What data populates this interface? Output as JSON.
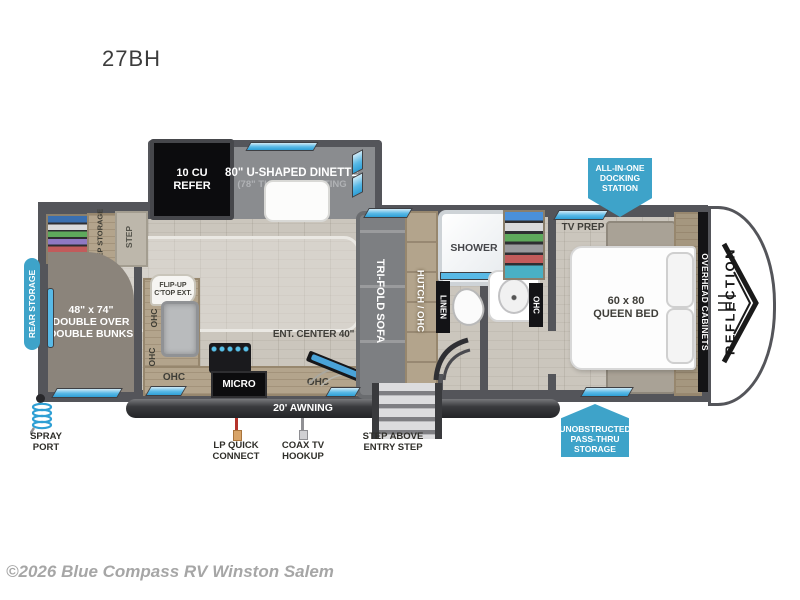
{
  "page": {
    "title": "27BH",
    "watermark": "©2026 Blue Compass RV Winston Salem"
  },
  "colors": {
    "badge_blue": "#3ea3c9",
    "wall_gray": "#54555a",
    "window_blue": "#58b9e6",
    "floor_wood": "#cbc6bd"
  },
  "floorplan": {
    "brand": "REFLECTION",
    "badges": {
      "docking_station": "ALL-IN-ONE\nDOCKING\nSTATION",
      "pass_thru": "UNOBSTRUCTED\nPASS-THRU\nSTORAGE",
      "rear_storage": "REAR STORAGE"
    },
    "bunk_room": {
      "bunks": "48\" x 74\"\nDOUBLE OVER\nDOUBLE BUNKS",
      "step_storage": "STEP STORAGE",
      "step": "STEP"
    },
    "kitchen": {
      "refer": "10 CU\nREFER",
      "flip_up": "FLIP-UP\nC'TOP EXT.",
      "micro": "MICRO",
      "ohc": "OHC"
    },
    "dinette": {
      "line1": "80\" U-SHAPED DINETTE",
      "line2": "(78\" THEATRE SEATING",
      "line3": "OPTIONAL)"
    },
    "living": {
      "sofa": "TRI-FOLD SOFA",
      "hutch": "HUTCH / OHC",
      "ent_center": "ENT. CENTER 40\" TV"
    },
    "bath": {
      "shower": "SHOWER",
      "linen": "LINEN",
      "ohc": "OHC"
    },
    "bedroom": {
      "tv_prep": "TV PREP",
      "bed": "60 x 80\nQUEEN BED",
      "overhead": "OVERHEAD CABINETS"
    },
    "exterior": {
      "awning": "20' AWNING",
      "spray_port": "SPRAY\nPORT",
      "lp_quick": "LP QUICK\nCONNECT",
      "coax": "COAX TV\nHOOKUP",
      "entry_step": "STEP ABOVE\nENTRY STEP"
    }
  }
}
